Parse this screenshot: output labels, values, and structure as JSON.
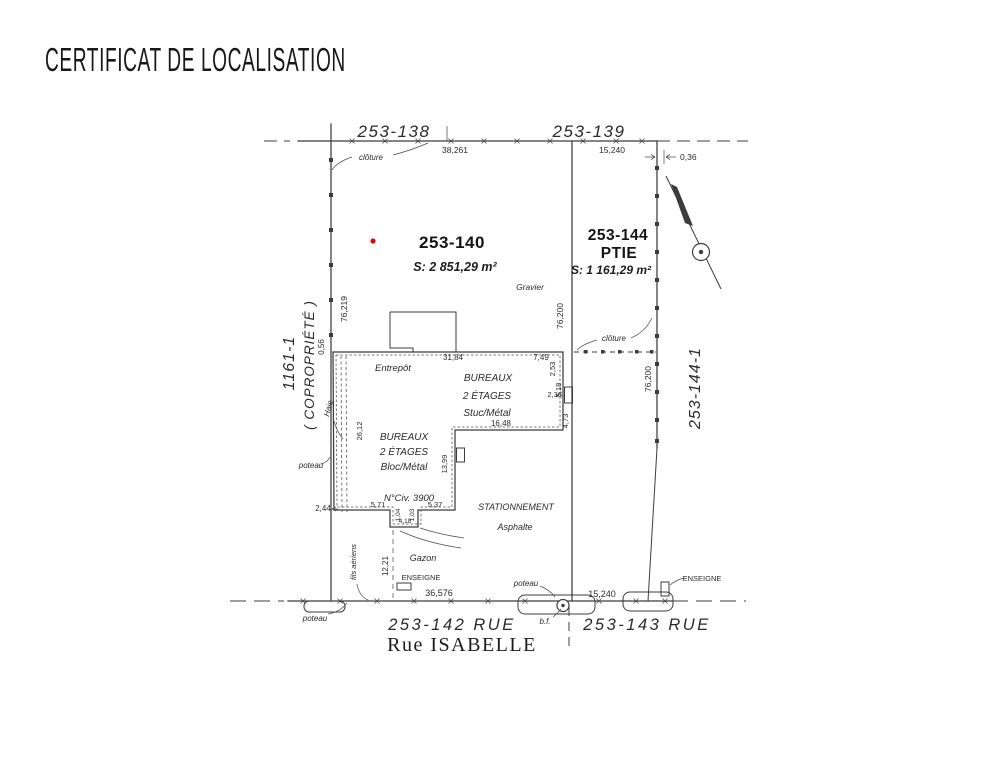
{
  "title": "CERTIFICAT DE LOCALISATION",
  "colors": {
    "ink": "#3c3c3c",
    "marker_red": "#cc1111"
  },
  "plan": {
    "lots": {
      "top_left": "253-138",
      "top_right": "253-139",
      "main_id": "253-140",
      "main_area": "S: 2 851,29 m²",
      "main_surface": "Gravier",
      "east_id": "253-144",
      "east_suffix": "PTIE",
      "east_area": "S: 1 161,29 m²",
      "west_id": "1161-1",
      "west_note": "( COPROPRIÉTÉ )",
      "east_outer": "253-144-1",
      "street_left": "253-142 RUE",
      "street_right": "253-143 RUE",
      "street_name": "Rue ISABELLE"
    },
    "buildings": {
      "warehouse": "Entrepôt",
      "office1_l1": "BUREAUX",
      "office1_l2": "2 ÉTAGES",
      "office1_l3": "Stuc/Métal",
      "office2_l1": "BUREAUX",
      "office2_l2": "2 ÉTAGES",
      "office2_l3": "Bloc/Métal",
      "civic": "N°Civ. 3900"
    },
    "features": {
      "fence_top": "clôture",
      "fence_mid": "clôture",
      "hedge": "Haie",
      "pole_left": "poteau",
      "pole_bottom": "poteau",
      "pole_mid": "poteau",
      "hydrant": "b.f.",
      "overhead_wires": "fils aériens",
      "sign_left": "ENSEIGNE",
      "sign_right": "ENSEIGNE",
      "lawn": "Gazon",
      "parking": "STATIONNEMENT",
      "parking_surface": "Asphalte"
    },
    "measurements": {
      "top_left": "38,261",
      "top_right": "15,240",
      "offset_ne": "0,36",
      "west_side": "76,219",
      "west_offset": "0,56",
      "mid_line": "76,200",
      "east_side": "76,200",
      "bldg_top": "31,84",
      "bldg_top_right": "7,49",
      "r1": "2,53",
      "r2": "5,18",
      "r3": "2,36",
      "r4": "4,73",
      "bldg_mid": "16,48",
      "bldg_inner": "13,99",
      "west_bldg": "26,12",
      "b1": "5,71",
      "b2": "5,37",
      "n1": "1,04",
      "n2": "1,03",
      "n3": "4,18",
      "sw_offset": "2,44",
      "lawn_depth": "12,21",
      "street_left": "36,576",
      "street_right": "15,240"
    }
  }
}
